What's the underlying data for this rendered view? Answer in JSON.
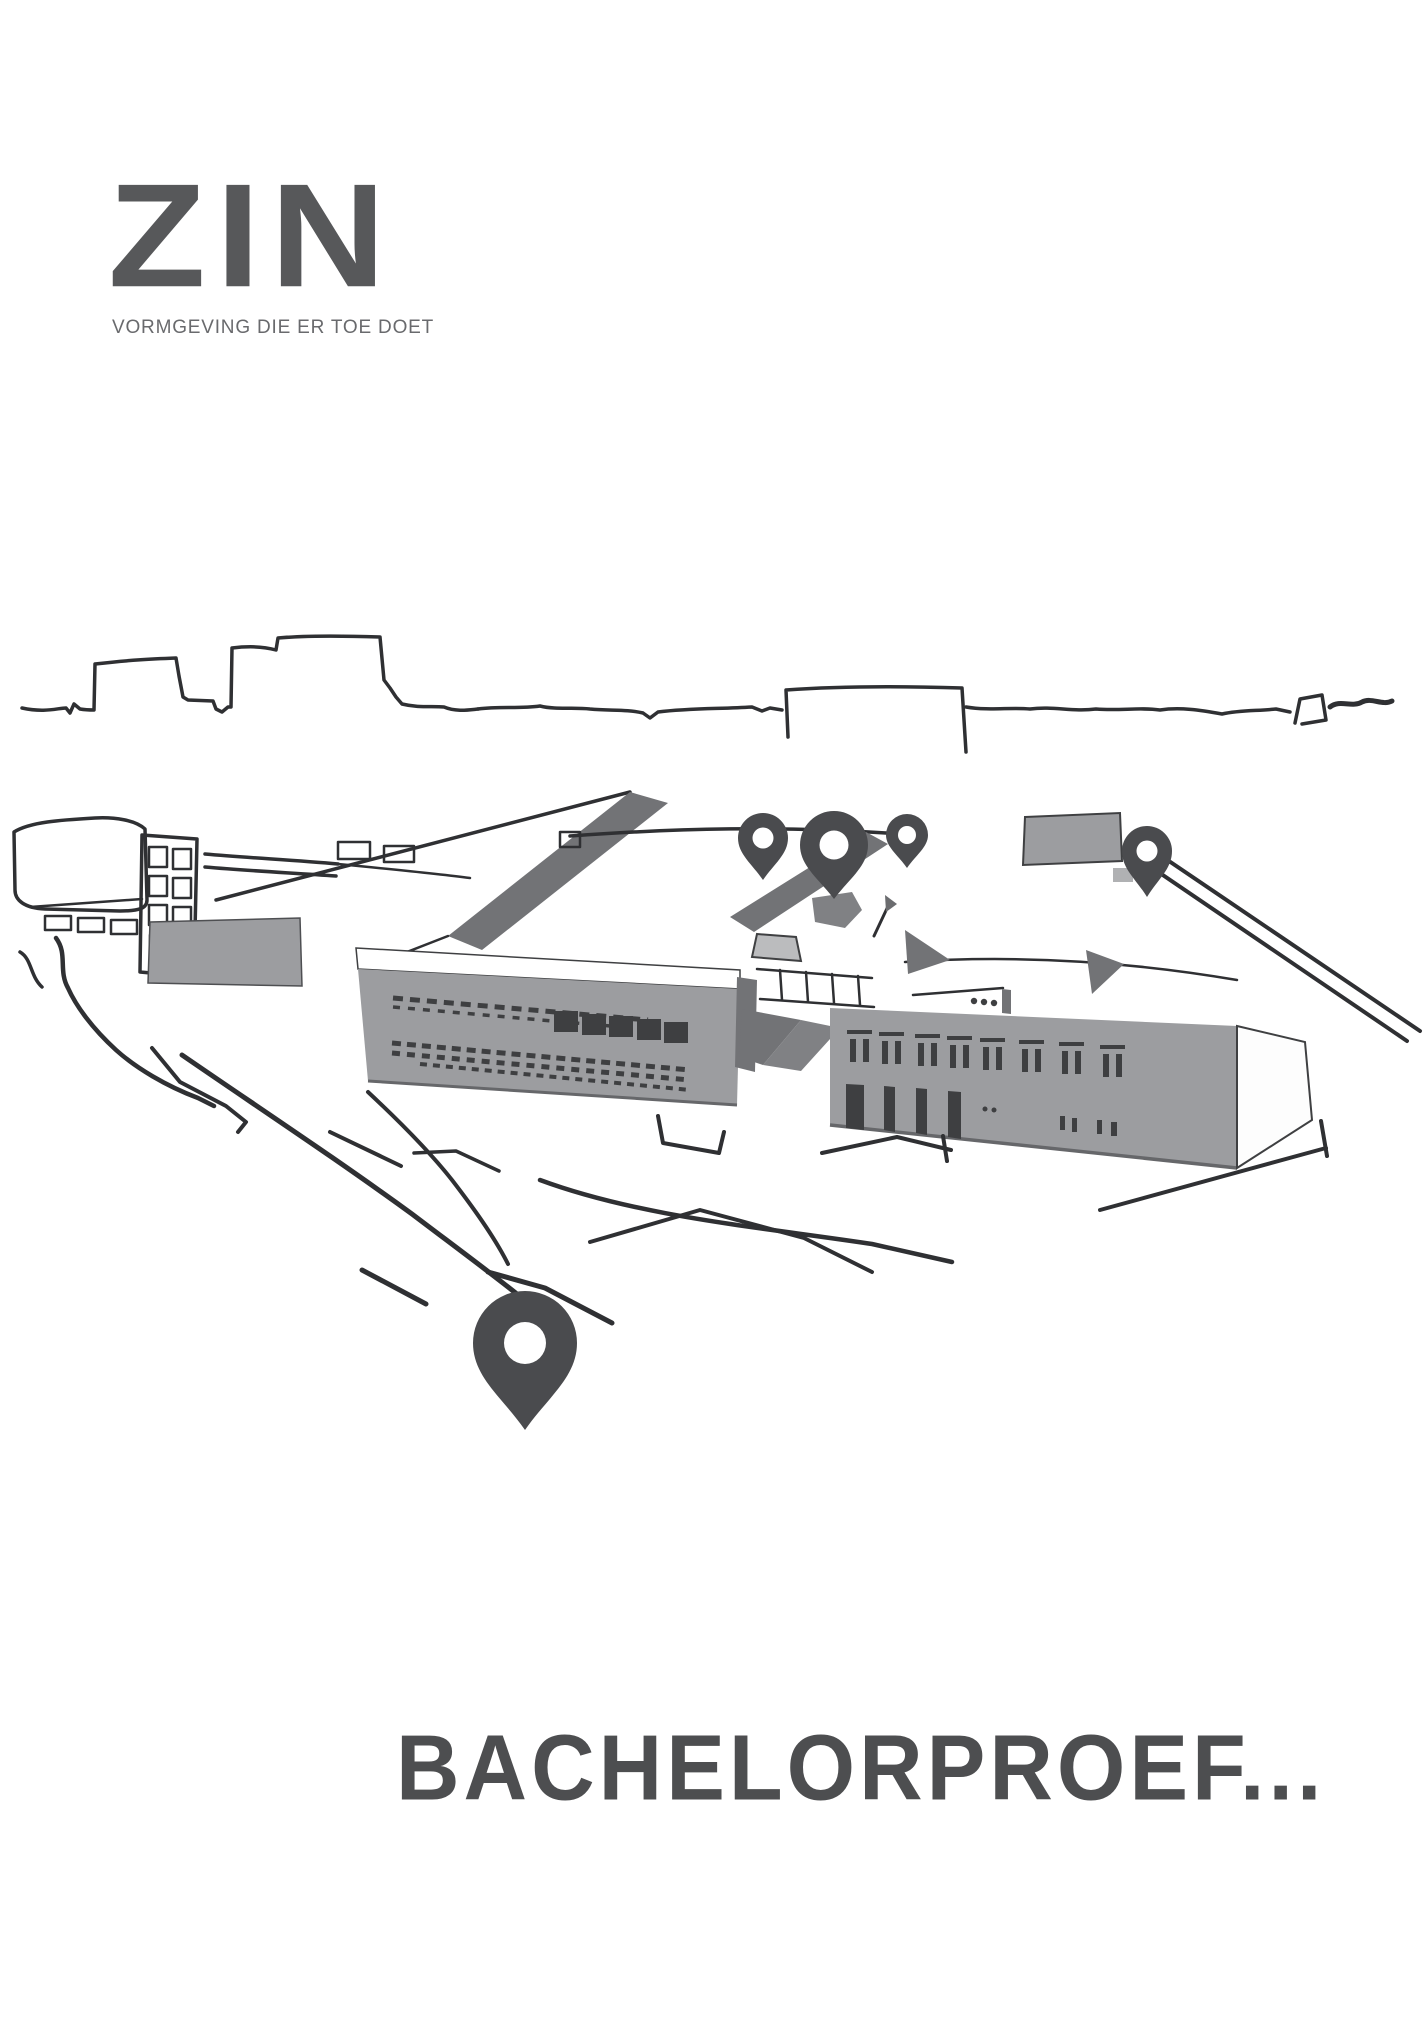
{
  "brand": {
    "logo_text": "ZIN",
    "tagline": "VORMGEVING DIE ER TOE DOET"
  },
  "cover": {
    "title": "BACHELORPROEF..."
  },
  "illustration": {
    "description": "Hand-drawn aerial sketch of an industrial campus site with a city skyline line, gray warehouse buildings, roads and five dark location map pins",
    "map_pin_count": 5
  },
  "colors": {
    "logo": "#57585a",
    "tagline": "#696a6d",
    "title": "#4d4e50",
    "pin": "#4a4b4e",
    "building": "#9c9da0",
    "roof_shadow": "#727376",
    "window": "#3e3f41",
    "sketch_line": "#2f3033"
  }
}
